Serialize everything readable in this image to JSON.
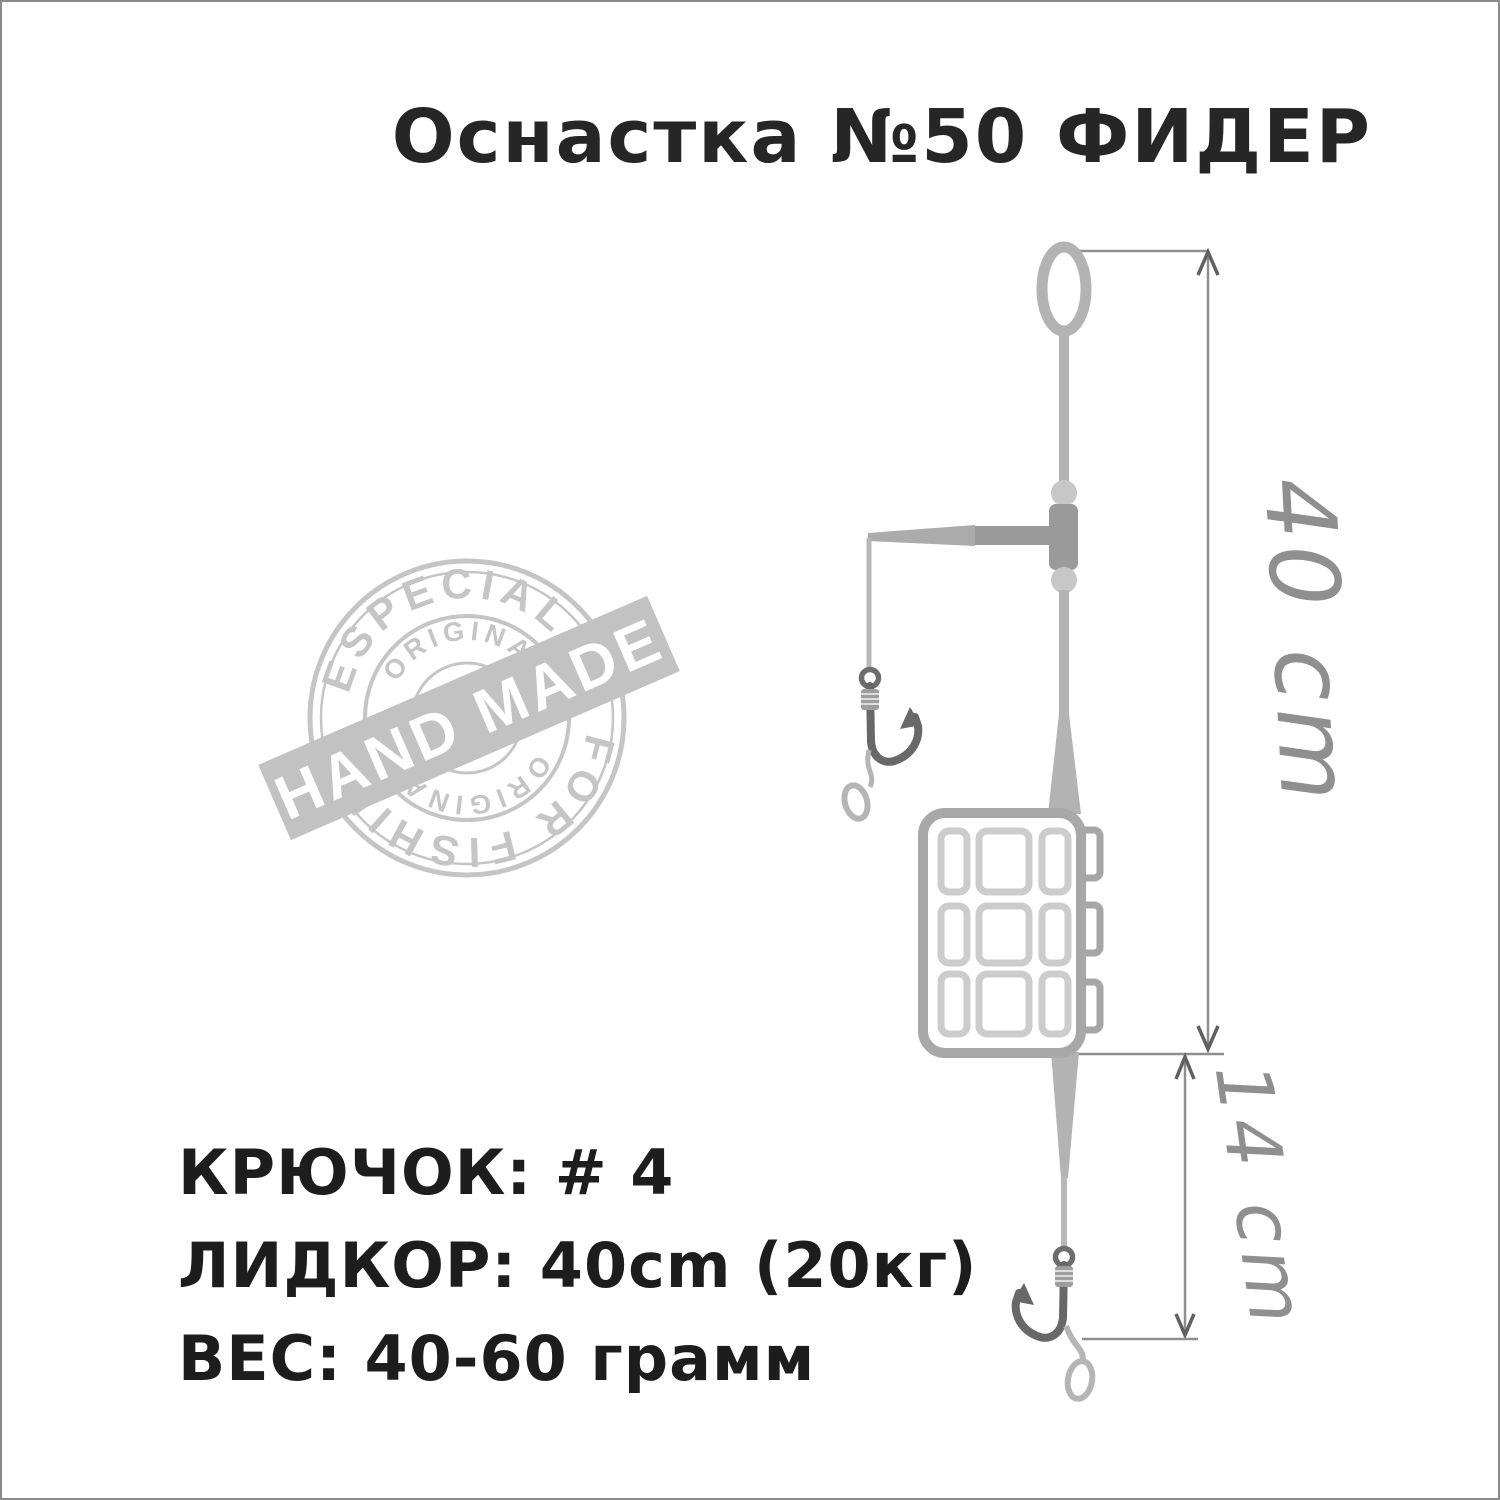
{
  "title": "Оснастка №50 ФИДЕР",
  "specs": {
    "lines": [
      "КРЮЧОК: # 4",
      "ЛИДКОР: 40cm (20кг)",
      "ВЕС: 40-60 грамм"
    ]
  },
  "dimensions": {
    "overall": "40 cm",
    "hooklink": "14 cm"
  },
  "stamp": {
    "arc_top": "ESPECIALLY",
    "arc_bottom": "FOR FISHING",
    "inner_arc_top": "ORIGINAL",
    "inner_arc_bottom": "ORIGINAL",
    "banner": "HAND MADE"
  },
  "colors": {
    "line_gray": "#b3b3b3",
    "fitting_gray": "#9a9a9a",
    "bead_gray": "#c7c7c7",
    "hook_gray": "#686868",
    "feeder_stroke": "#a8a8a8",
    "feeder_grid": "#cccccc",
    "dimension_gray": "#8f8f8f",
    "stamp_gray": "#c5c5c5",
    "text_black": "#1d1d1d"
  }
}
